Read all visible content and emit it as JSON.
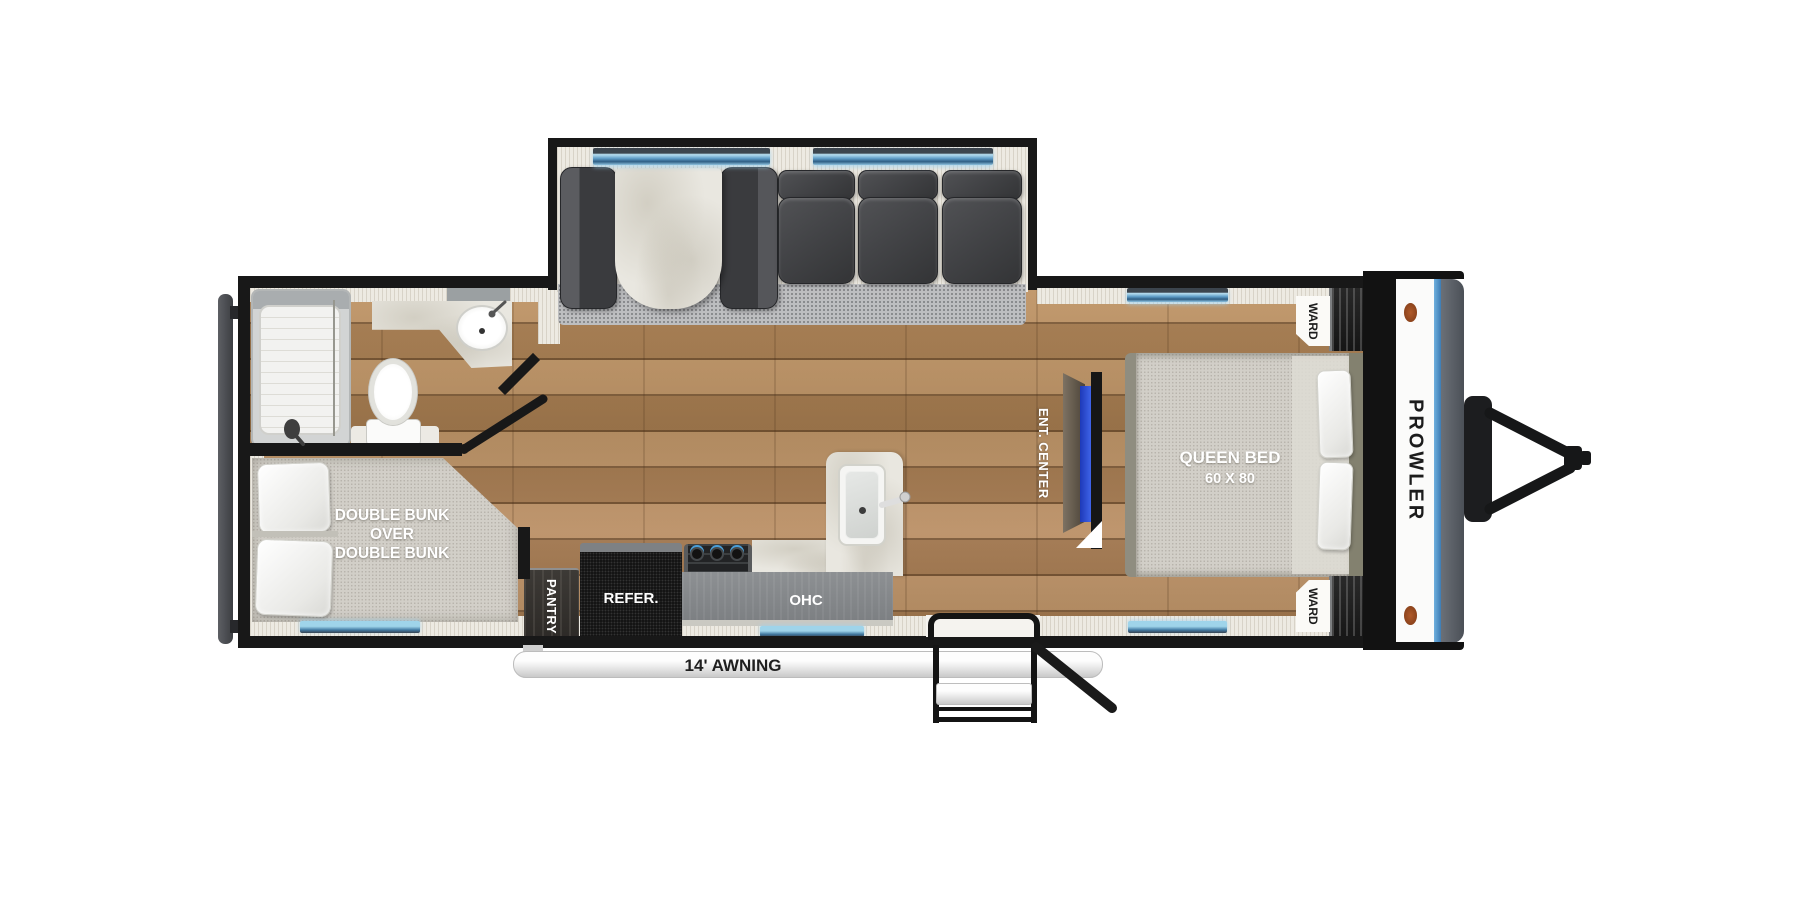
{
  "title": "Prowler travel trailer floor plan",
  "brand": "PROWLER",
  "labels": {
    "bunk_line1": "DOUBLE BUNK",
    "bunk_line2": "OVER",
    "bunk_line3": "DOUBLE BUNK",
    "pantry": "PANTRY",
    "refrigerator": "REFER.",
    "overhead_cabinet": "OHC",
    "ent_center": "ENT. CENTER",
    "queen_bed": "QUEEN BED",
    "queen_bed_size": "60 X 80",
    "wardrobe_front_top": "WARD",
    "wardrobe_front_bottom": "WARD",
    "awning": "14' AWNING"
  },
  "colors": {
    "wall": "#181818",
    "wood_floor": "#a8815a",
    "window_blue": "#5e9cc6",
    "tv_screen_blue": "#2b4fd4",
    "front_cap_stripe": "#4d8fd1",
    "marker_orange": "#a0522d",
    "carpet": "#bdbec0",
    "lining": "#edeae2"
  }
}
